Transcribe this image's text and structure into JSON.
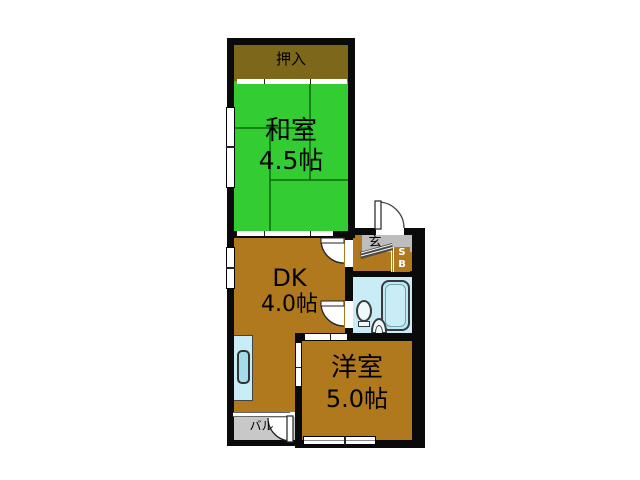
{
  "floorplan": {
    "rooms": [
      {
        "id": "oshiire",
        "label": "押入",
        "size": ""
      },
      {
        "id": "washitsu",
        "label": "和室",
        "size": "4.5帖"
      },
      {
        "id": "dk",
        "label": "DK",
        "size": "4.0帖"
      },
      {
        "id": "yoshitsu",
        "label": "洋室",
        "size": "5.0帖"
      },
      {
        "id": "genkan",
        "label": "玄",
        "size": ""
      },
      {
        "id": "balcony",
        "label": "バル",
        "size": ""
      }
    ],
    "shoebox": {
      "line1": "S",
      "line2": "B"
    },
    "fixtures": [
      "bathtub",
      "toilet",
      "washbasin",
      "kitchen-sink",
      "entrance-door",
      "balcony-door"
    ],
    "colors": {
      "tatami_green": "#33CC33",
      "wood_brown": "#B1791D",
      "closet_olive": "#7D671B",
      "bath_blue": "#C9EDF6",
      "genkan_gray": "#BDBDBD",
      "balcony_gray": "#C8C8C8",
      "wall_black": "#0A0A0A"
    }
  }
}
